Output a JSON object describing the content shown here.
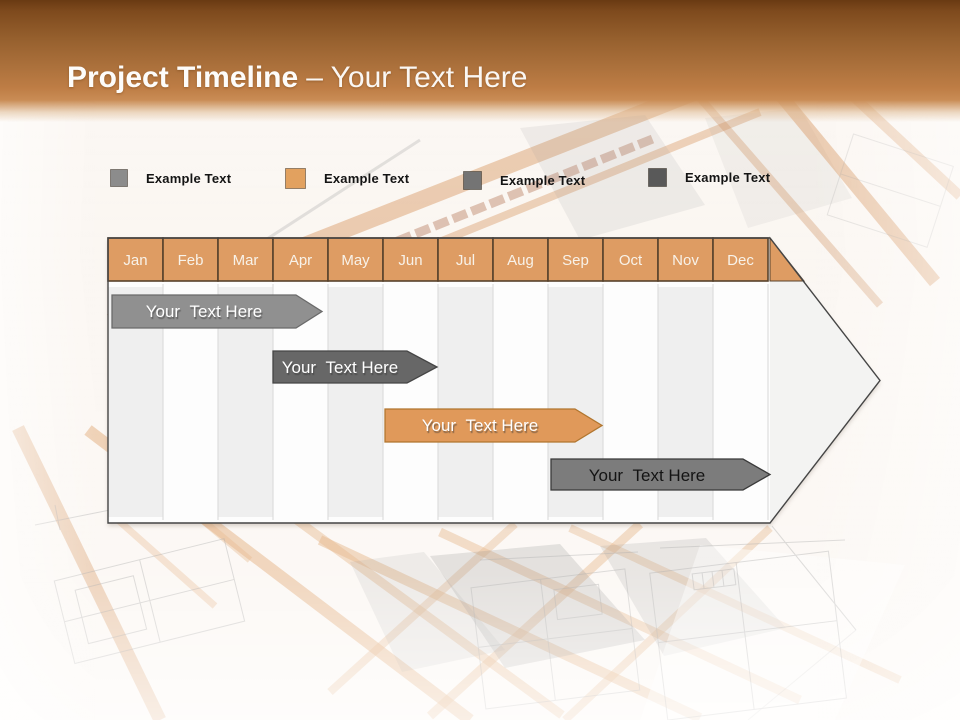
{
  "slide": {
    "title": {
      "main": "Project Timeline",
      "sub": "– Your Text Here"
    }
  },
  "legend": {
    "items": [
      {
        "label": "Example Text",
        "color": "#8C8C8C"
      },
      {
        "label": "Example Text",
        "color": "#E2A15F"
      },
      {
        "label": "Example Text",
        "color": "#747474"
      },
      {
        "label": "Example Text",
        "color": "#595959"
      }
    ]
  },
  "timeline": {
    "months": [
      "Jan",
      "Feb",
      "Mar",
      "Apr",
      "May",
      "Jun",
      "Jul",
      "Aug",
      "Sep",
      "Oct",
      "Nov",
      "Dec"
    ],
    "colors": {
      "header": "#DE9C63",
      "panel": "#F3F3F2",
      "grid_base": "#FDFDFD",
      "stripe": "#EFEFEF"
    },
    "bars": [
      {
        "label": "Your  Text Here",
        "color": "#909090",
        "border": "#6A6A6A",
        "text_color": "#FFFFFF"
      },
      {
        "label": "Your  Text Here",
        "color": "#676767",
        "border": "#454545",
        "text_color": "#FFFFFF"
      },
      {
        "label": "Your  Text Here",
        "color": "#E0995A",
        "border": "#B1762F",
        "text_color": "#FFFFFF"
      },
      {
        "label": "Your  Text Here",
        "color": "#7C7C7C",
        "border": "#3A3A3A",
        "text_color": "#141414"
      }
    ]
  },
  "chart_data": {
    "type": "bar",
    "subtype": "gantt-timeline-arrow",
    "title": "Project Timeline – Your Text Here",
    "categories": [
      "Jan",
      "Feb",
      "Mar",
      "Apr",
      "May",
      "Jun",
      "Jul",
      "Aug",
      "Sep",
      "Oct",
      "Nov",
      "Dec"
    ],
    "series": [
      {
        "name": "Task 1",
        "label": "Your Text Here",
        "start_index": 0.0,
        "end_index": 3.9,
        "start_month": "Jan",
        "end_month": "mid-Apr",
        "color": "#909090"
      },
      {
        "name": "Task 2",
        "label": "Your Text Here",
        "start_index": 3.0,
        "end_index": 6.0,
        "start_month": "Apr",
        "end_month": "end-Jun",
        "color": "#676767"
      },
      {
        "name": "Task 3",
        "label": "Your Text Here",
        "start_index": 5.0,
        "end_index": 9.0,
        "start_month": "Jun",
        "end_month": "end-Sep",
        "color": "#E0995A"
      },
      {
        "name": "Task 4",
        "label": "Your Text Here",
        "start_index": 8.0,
        "end_index": 12.0,
        "start_month": "Sep",
        "end_month": "end-Dec",
        "color": "#7C7C7C"
      }
    ],
    "legend": [
      "Example Text",
      "Example Text",
      "Example Text",
      "Example Text"
    ],
    "legend_position": "top",
    "xlabel": "",
    "ylabel": "",
    "grid": "vertical month columns, alternating stripes"
  }
}
